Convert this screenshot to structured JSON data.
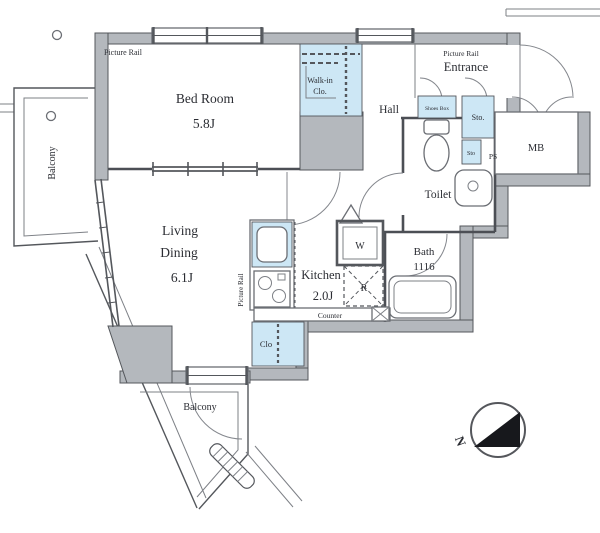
{
  "title": "Apartment Floor Plan",
  "colors": {
    "wall": "#b4b8bd",
    "storage_blue": "#cde7f5",
    "line": "#54575c",
    "text": "#2b2d33",
    "compass_fill": "#17181c"
  },
  "rooms": {
    "bedroom": {
      "name": "Bed Room",
      "size": "5.8J"
    },
    "living_dining": {
      "name_line1": "Living",
      "name_line2": "Dining",
      "size": "6.1J"
    },
    "kitchen": {
      "name": "Kitchen",
      "size": "2.0J"
    },
    "hall": {
      "name": "Hall"
    },
    "entrance": {
      "name": "Entrance"
    },
    "toilet": {
      "name": "Toilet"
    },
    "bath": {
      "name": "Bath",
      "size": "1116"
    },
    "walk_in_closet": {
      "name_line1": "Walk-in",
      "name_line2": "Clo."
    },
    "balcony": {
      "name": "Balcony"
    }
  },
  "features": {
    "picture_rail": "Picture Rail",
    "shoes_box": "Shoes Box",
    "storage_large": "Sto.",
    "storage_small": "Sto",
    "pipe_space": "PS",
    "meter_box": "MB",
    "washer": "W",
    "refrigerator": "R",
    "counter": "Counter",
    "closet": "Clo",
    "compass_north": "N"
  }
}
